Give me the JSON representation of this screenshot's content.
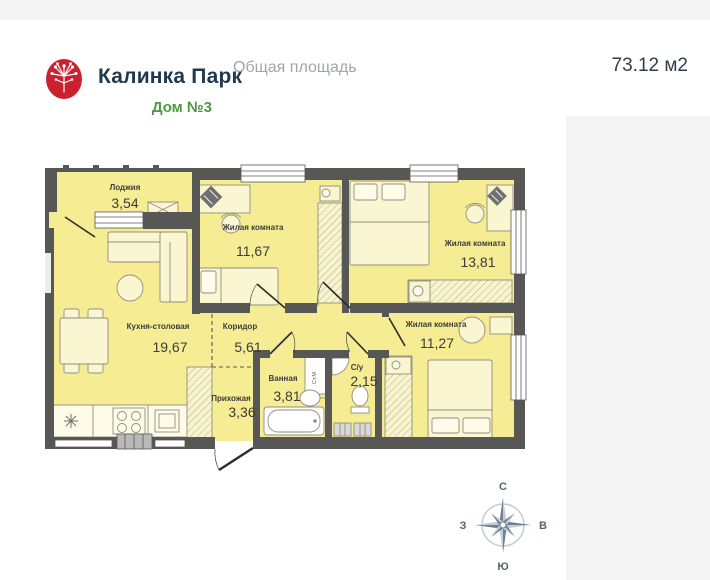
{
  "header": {
    "brand": "Калинка Парк",
    "house": "Дом №3",
    "area_label": "Общая площадь",
    "area_value": "73.12 м2"
  },
  "rooms": [
    {
      "name": "Лоджия",
      "area": "3,54"
    },
    {
      "name": "Жилая комната",
      "area": "11,67"
    },
    {
      "name": "Жилая комната",
      "area": "13,81"
    },
    {
      "name": "Кухня-столовая",
      "area": "19,67"
    },
    {
      "name": "Коридор",
      "area": "5,61"
    },
    {
      "name": "Жилая комната",
      "area": "11,27"
    },
    {
      "name": "Ванная",
      "area": "3,81"
    },
    {
      "name": "С/у",
      "area": "2,15"
    },
    {
      "name": "Прихожая",
      "area": "3,36"
    }
  ],
  "labels": {
    "washing_machine": "Ст.М"
  },
  "compass": {
    "north": "С",
    "south": "Ю",
    "west": "З",
    "east": "В"
  },
  "colors": {
    "brand_red": "#cb2030",
    "brand_navy": "#20394e",
    "brand_green": "#4e9940",
    "muted_text": "#9ea7ae",
    "wall": "#575756",
    "room_fill": "#f6ec93",
    "furniture_fill": "#fbf6d2",
    "compass_dark": "#6e8091",
    "compass_light": "#c2ccd4",
    "panel_gray": "#f4f4f4"
  }
}
